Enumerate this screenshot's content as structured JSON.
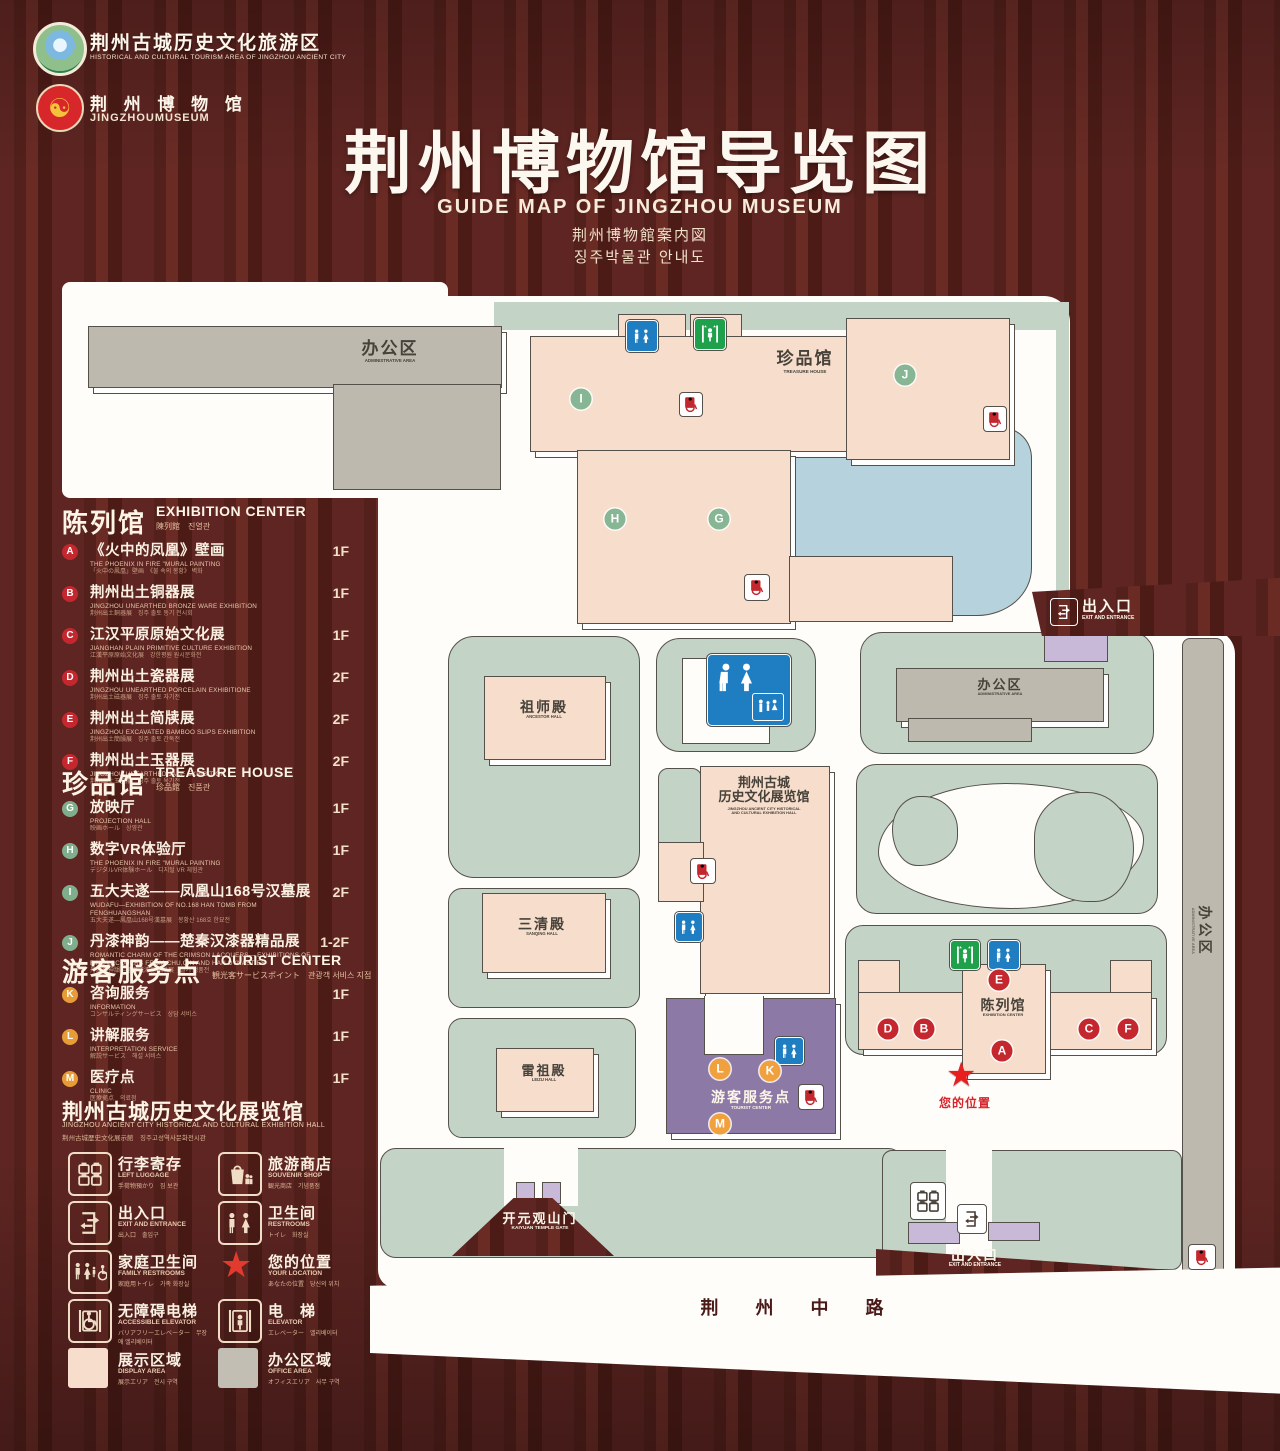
{
  "header": {
    "logo1": {
      "zh": "荆州古城历史文化旅游区",
      "en": "HISTORICAL AND CULTURAL TOURISM AREA OF JINGZHOU ANCIENT CITY"
    },
    "logo2": {
      "zh": "荆 州 博 物 馆",
      "en": "JINGZHOUMUSEUM"
    },
    "title": "荆州博物馆导览图",
    "subtitle_en": "GUIDE MAP OF JINGZHOU MUSEUM",
    "subtitle_ja": "荆州博物館案内図",
    "subtitle_ko": "징주박물관 안내도"
  },
  "sidebar": {
    "exhibition": {
      "zh": "陈列馆",
      "en": "EXHIBITION CENTER",
      "sub": "陳列館　진열관",
      "items": [
        {
          "id": "A",
          "zh": "《火中的凤凰》壁画",
          "floor": "1F",
          "en": "THE PHOENIX IN FIRE \"MURAL PAINTING",
          "sub": "「火中の鳳凰」壁画　《불 속의 봉황》 벽화"
        },
        {
          "id": "B",
          "zh": "荆州出土铜器展",
          "floor": "1F",
          "en": "JINGZHOU UNEARTHED BRONZE WARE EXHIBITION",
          "sub": "荆州出土銅器展　징주 출토 동기 전시회"
        },
        {
          "id": "C",
          "zh": "江汉平原原始文化展",
          "floor": "1F",
          "en": "JIANGHAN PLAIN PRIMITIVE CULTURE EXHIBITION",
          "sub": "江漢平原原始文化展　강한평원 원시문화전"
        },
        {
          "id": "D",
          "zh": "荆州出土瓷器展",
          "floor": "2F",
          "en": "JINGZHOU UNEARTHED PORCELAIN EXHIBITIONE",
          "sub": "荆州出土磁器展　징주 출토 자기전"
        },
        {
          "id": "E",
          "zh": "荆州出土简牍展",
          "floor": "2F",
          "en": "JINGZHOU EXCAVATED BAMBOO SLIPS EXHIBITION",
          "sub": "荆州出土簡牘展　징주 출토 간독전"
        },
        {
          "id": "F",
          "zh": "荆州出土玉器展",
          "floor": "2F",
          "en": "JINGZHOU UNEARTHED JADE EXHIBITION",
          "sub": "荆州出土玉器展　징주 출토 옥기전"
        }
      ]
    },
    "treasure": {
      "zh": "珍品馆",
      "en": "TREASURE HOUSE",
      "sub": "珍品館　진품관",
      "items": [
        {
          "id": "G",
          "zh": "放映厅",
          "floor": "1F",
          "en": "PROJECTION HALL",
          "sub": "映画ホール　상영관"
        },
        {
          "id": "H",
          "zh": "数字VR体验厅",
          "floor": "1F",
          "en": "THE PHOENIX IN FIRE \"MURAL PAINTING",
          "sub": "デジタルVR体験ホール　디지털 VR 체험관"
        },
        {
          "id": "I",
          "zh": "五大夫遂——凤凰山168号汉墓展",
          "floor": "2F",
          "en": "WUDAFU—EXHIBITION OF NO.168 HAN TOMB FROM FENGHUANGSHAN",
          "sub": "五大夫遂—鳳凰山168号漢墓展　봉황산 168호 한묘전"
        },
        {
          "id": "J",
          "zh": "丹漆神韵——楚秦汉漆器精品展",
          "floor": "1-2F",
          "en": "ROMANTIC CHARM OF THE CRIMSON LACQUERS— EXHIBITIONS OF FINE LACQUERS FROM CHU,QIN AND HAN DYNASTIES",
          "sub": "丹漆の神韻—楚秦漢漆器精品展　칠기 정품전"
        }
      ]
    },
    "tourist": {
      "zh": "游客服务点",
      "en": "TOURIST CENTER",
      "sub": "観光客サービスポイント　관광객 서비스 지점",
      "items": [
        {
          "id": "K",
          "zh": "咨询服务",
          "floor": "1F",
          "en": "INFORMATION",
          "sub": "コンサルティングサービス　상담 서비스"
        },
        {
          "id": "L",
          "zh": "讲解服务",
          "floor": "1F",
          "en": "INTERPRETATION SERVICE",
          "sub": "解説サービス　해설 서비스"
        },
        {
          "id": "M",
          "zh": "医疗点",
          "floor": "1F",
          "en": "CLINIC",
          "sub": "医療拠点　의료점"
        }
      ]
    },
    "hall_title": {
      "zh": "荆州古城历史文化展览馆",
      "en": "JINGZHOU ANCIENT CITY HISTORICAL AND CULTURAL EXHIBITION HALL",
      "sub": "荆州古城歴史文化展示館　징주고성역사문화전시관"
    },
    "legend": {
      "items": [
        {
          "icon": "luggage",
          "zh": "行李寄存",
          "en": "LEFT LUGGAGE",
          "sub": "手荷物預かり　짐 보관"
        },
        {
          "icon": "shop",
          "zh": "旅游商店",
          "en": "SOUVENIR SHOP",
          "sub": "観光商店　기념품점"
        },
        {
          "icon": "exit",
          "zh": "出入口",
          "en": "EXIT AND ENTRANCE",
          "sub": "出入口　출입구"
        },
        {
          "icon": "restroom",
          "zh": "卫生间",
          "en": "RESTROOMS",
          "sub": "トイレ　화장실"
        },
        {
          "icon": "family",
          "zh": "家庭卫生间",
          "en": "FAMILY RESTROOMS",
          "sub": "家庭用トイレ　가족 화장실"
        },
        {
          "icon": "star",
          "zh": "您的位置",
          "en": "YOUR LOCATION",
          "sub": "あなたの位置　당신의 위치"
        },
        {
          "icon": "access",
          "zh": "无障碍电梯",
          "en": "ACCESSIBLE ELEVATOR",
          "sub": "バリアフリーエレベーター　무장애 엘리베이터"
        },
        {
          "icon": "elevator",
          "zh": "电　梯",
          "en": "ELEVATOR",
          "sub": "エレベーター　엘리베이터"
        },
        {
          "icon": "display",
          "zh": "展示区域",
          "en": "DISPLAY AREA",
          "sub": "展示エリア　전시 구역"
        },
        {
          "icon": "office",
          "zh": "办公区域",
          "en": "OFFICE AREA",
          "sub": "オフィスエリア　사무 구역"
        }
      ]
    }
  },
  "map": {
    "admin_nw": {
      "zh": "办公区",
      "en": "ADMINISTRATIVE AREA"
    },
    "treasure": {
      "zh": "珍品馆",
      "en": "TREASURE HOUSE"
    },
    "ancestor": {
      "zh": "祖师殿",
      "en": "ANCESTOR HALL"
    },
    "sanqing": {
      "zh": "三清殿",
      "en": "SANQING HALL"
    },
    "leizu": {
      "zh": "雷祖殿",
      "en": "LEIZU HALL"
    },
    "hall": {
      "zh1": "荆州古城",
      "zh2": "历史文化展览馆",
      "en1": "JINGZHOU ANCIENT CITY HISTORICAL",
      "en2": "AND CULTURAL EXHIBITION HALL"
    },
    "exhibition": {
      "zh": "陈列馆",
      "en": "EXHIBITION CENTER"
    },
    "admin_e": {
      "zh": "办公区",
      "en": "ADMINISTRATIVE AREA"
    },
    "admin_strip": {
      "zh": "办公区",
      "en": "ADMINISTRATIVE AREA"
    },
    "tourist": {
      "zh": "游客服务点",
      "en": "TOURIST CENTER"
    },
    "gate": {
      "zh": "开元观山门",
      "en": "KAIYUAN TEMPLE GATE"
    },
    "exit_ne": {
      "zh": "出入口",
      "en": "EXIT AND ENTRANCE"
    },
    "exit_s": {
      "zh": "出入口",
      "en": "EXIT AND ENTRANCE"
    },
    "road": "荆 州 中 路",
    "your_location": "您的位置",
    "markers": [
      {
        "letter": "A",
        "type": "red"
      },
      {
        "letter": "B",
        "type": "red"
      },
      {
        "letter": "C",
        "type": "red"
      },
      {
        "letter": "D",
        "type": "red"
      },
      {
        "letter": "E",
        "type": "red"
      },
      {
        "letter": "F",
        "type": "red"
      },
      {
        "letter": "G",
        "type": "grn"
      },
      {
        "letter": "H",
        "type": "grn"
      },
      {
        "letter": "I",
        "type": "grn"
      },
      {
        "letter": "J",
        "type": "grn"
      },
      {
        "letter": "K",
        "type": "org"
      },
      {
        "letter": "L",
        "type": "org"
      },
      {
        "letter": "M",
        "type": "org"
      }
    ]
  }
}
